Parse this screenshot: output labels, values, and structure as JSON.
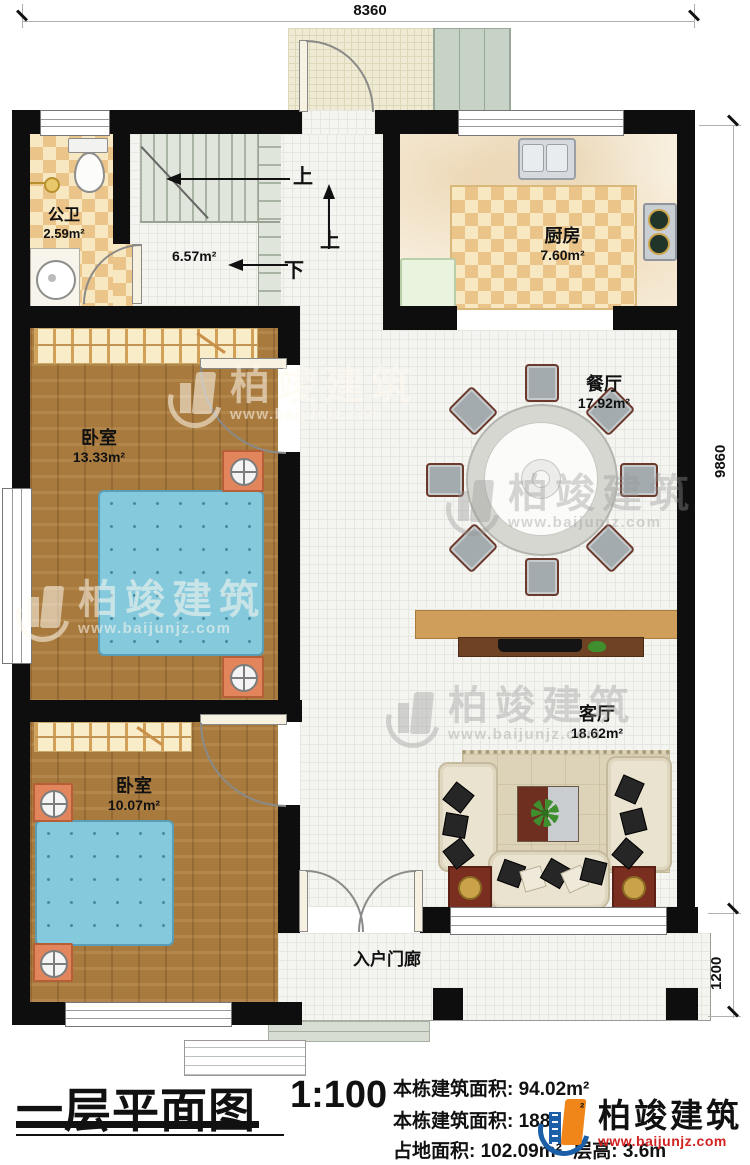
{
  "plan": {
    "dimensions": {
      "width_top": "8360",
      "height_right": "9860",
      "porch_height_right": "1200"
    },
    "rooms": {
      "bathroom": {
        "name": "公卫",
        "area": "2.59m²"
      },
      "stair_hall": {
        "area": "6.57m²"
      },
      "kitchen": {
        "name": "厨房",
        "area": "7.60m²"
      },
      "dining": {
        "name": "餐厅",
        "area": "17.92m²"
      },
      "bedroom1": {
        "name": "卧室",
        "area": "13.33m²"
      },
      "bedroom2": {
        "name": "卧室",
        "area": "10.07m²"
      },
      "living": {
        "name": "客厅",
        "area": "18.62m²"
      },
      "porch": {
        "name": "入户门廊"
      }
    },
    "stair_annotations": {
      "up_main": "上",
      "up_entry": "上",
      "down": "下"
    }
  },
  "title_block": {
    "title": "一层平面图",
    "scale": "1:100",
    "line1_label": "本栋建筑面积:",
    "line1_value": "94.02m²",
    "line2_label": "本栋建筑面积:",
    "line2_value": "188.",
    "line2_sup": "²",
    "line3a_label": "占地面积:",
    "line3a_value": "102.09m²",
    "line3b_label": "层高:",
    "line3b_value": "3.6m"
  },
  "branding": {
    "watermark_brand": "柏竣建筑",
    "watermark_url": "www.baijunjz.com",
    "logo_brand": "柏竣建筑",
    "logo_url": "www.baijunjz.com",
    "colors": {
      "logo_blue": "#1a5fa8",
      "logo_orange": "#f08519",
      "logo_url_red": "#d22222",
      "wall_black": "#0e0e0e"
    }
  }
}
